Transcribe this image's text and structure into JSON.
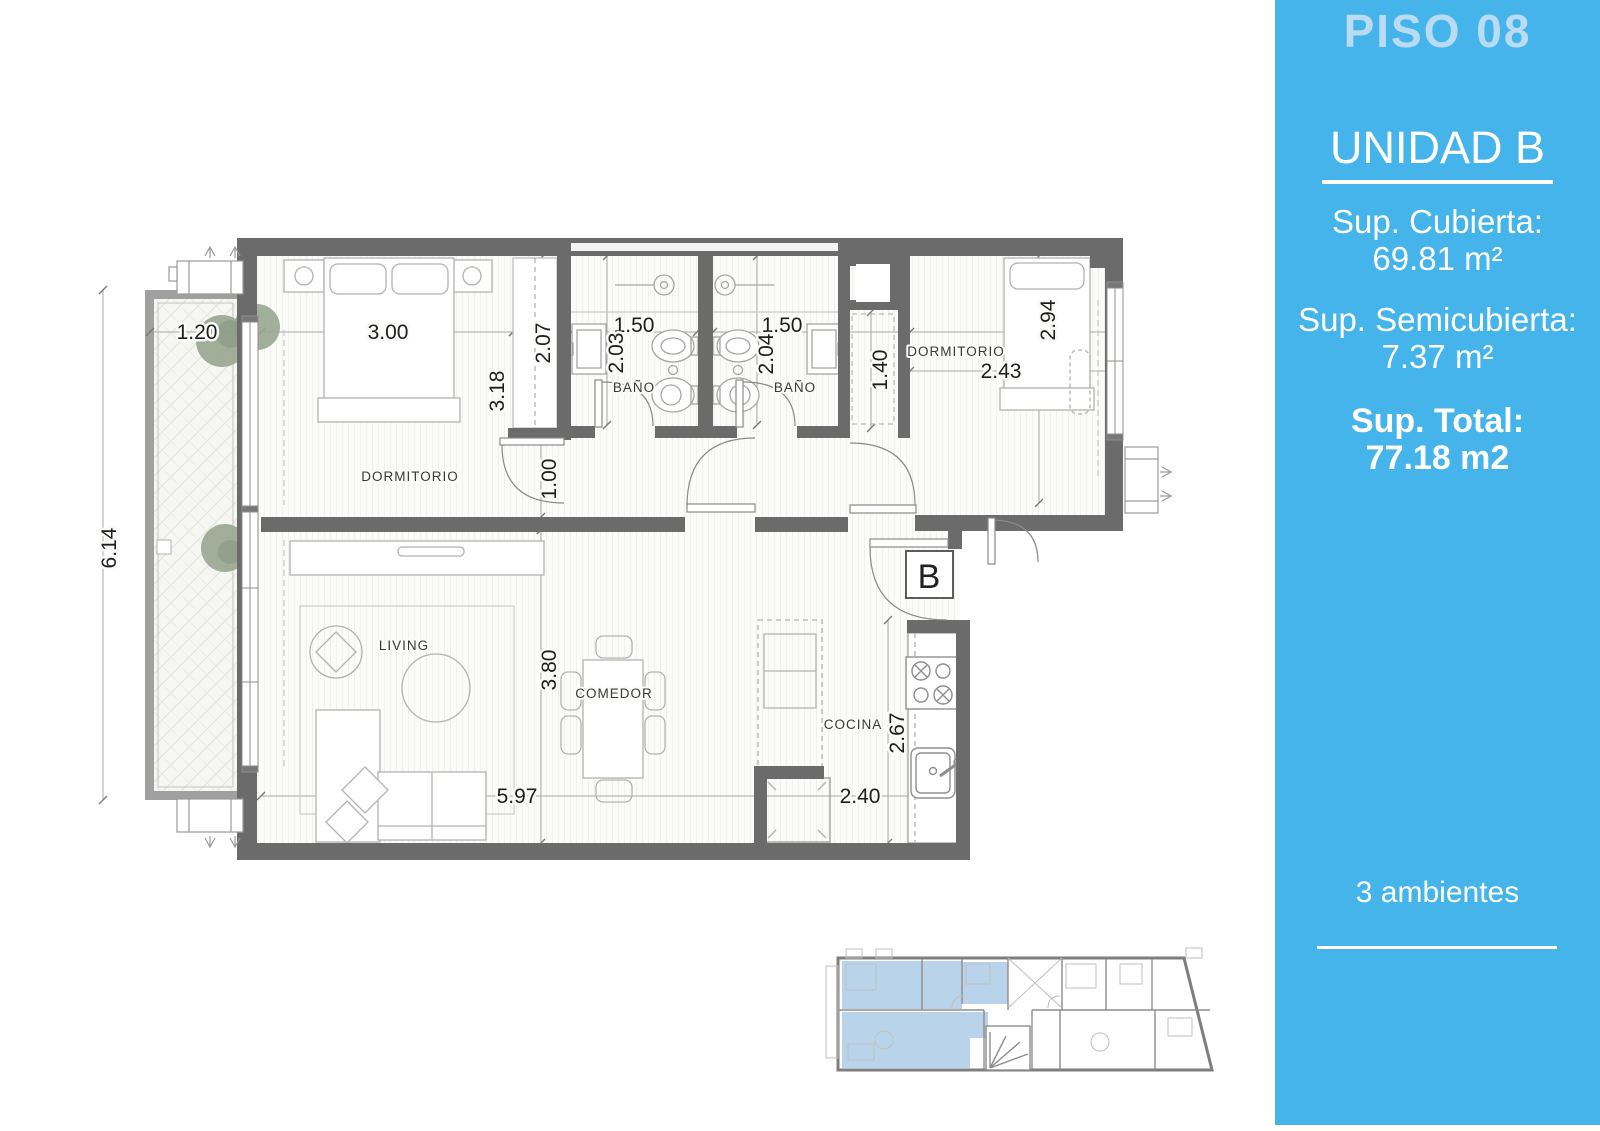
{
  "sidebar": {
    "floor_title": "PISO 08",
    "unit_title": "UNIDAD B",
    "covered_label": "Sup. Cubierta:",
    "covered_value": "69.81 m²",
    "semi_label": "Sup. Semicubierta:",
    "semi_value": "7.37 m²",
    "total_label": "Sup. Total:",
    "total_value": "77.18 m2",
    "rooms_note": "3 ambientes",
    "panel_color": "#45B4EA",
    "floor_title_color": "#B9DCF3",
    "text_color": "#FFFFFF"
  },
  "plan": {
    "unit_badge": "B",
    "room_labels": {
      "bedroom1": "DORMITORIO",
      "bath1": "BAÑO",
      "bath2": "BAÑO",
      "bedroom2": "DORMITORIO",
      "living": "LIVING",
      "dining": "COMEDOR",
      "kitchen": "COCINA"
    },
    "dimensions": {
      "balcony_width": "1.20",
      "bedroom1_width": "3.00",
      "closet_depth": "2.07",
      "bedroom1_depth": "3.18",
      "bath1_width": "1.50",
      "bath1_depth": "2.03",
      "bath2_width": "1.50",
      "bath2_depth": "2.04",
      "passage_width": "1.40",
      "bedroom2_width": "2.43",
      "bedroom2_depth": "2.94",
      "hall_width": "1.00",
      "balcony_length": "6.14",
      "living_depth": "3.80",
      "living_width": "5.97",
      "kitchen_width": "2.40",
      "kitchen_depth": "2.67"
    },
    "wall_color": "#6B6B6B",
    "mini_highlight_color": "#B9D4EA"
  }
}
